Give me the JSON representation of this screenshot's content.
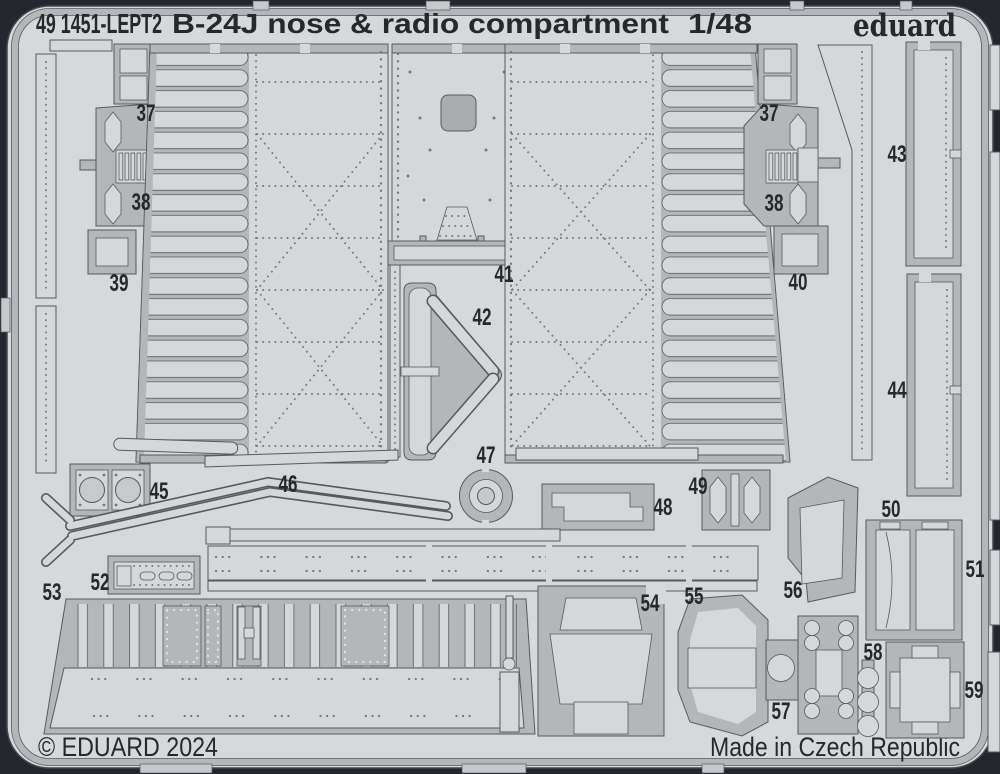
{
  "sheet": {
    "header": {
      "catalog_number": "49 1451-LEPT2",
      "title": "B-24J nose & radio compartment",
      "scale": "1/48",
      "brand": "eduard"
    },
    "footer": {
      "copyright": "© EDUARD 2024",
      "origin": "Made in Czech Republic"
    },
    "part_labels": {
      "p37_left": "37",
      "p38_left": "38",
      "p39": "39",
      "p37_right": "37",
      "p38_right": "38",
      "p40": "40",
      "p41": "41",
      "p42": "42",
      "p43": "43",
      "p44": "44",
      "p45": "45",
      "p46": "46",
      "p47": "47",
      "p48": "48",
      "p49": "49",
      "p50": "50",
      "p51": "51",
      "p52": "52",
      "p53": "53",
      "p54": "54",
      "p55": "55",
      "p56": "56",
      "p57": "57",
      "p58": "58",
      "p59": "59"
    },
    "colors": {
      "background": "#23272d",
      "sheet": "#d6d9da",
      "metal": "#b3b7ba",
      "part_light": "#d5d8da",
      "cutout": "#a9adb0",
      "recess": "#c7cacc",
      "outline": "#565a5e",
      "rivet": "#74787c",
      "text": "#26292c"
    }
  }
}
